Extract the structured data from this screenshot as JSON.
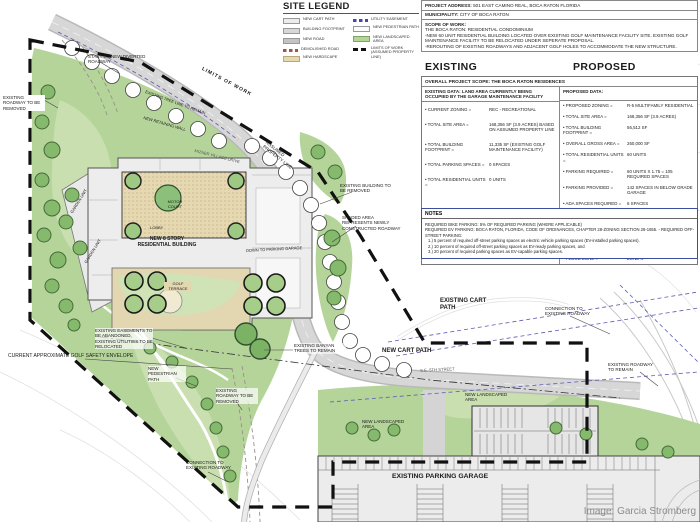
{
  "legend": {
    "title": "SITE LEGEND",
    "col1": [
      {
        "label": "NEW CART PATH"
      },
      {
        "label": "BUILDING FOOTPRINT"
      },
      {
        "label": "NEW ROAD"
      },
      {
        "label": "DEMOLISHED ROAD"
      },
      {
        "label": "NEW HARDSCAPE"
      }
    ],
    "col2": [
      {
        "label": "UTILITY EASEMENT"
      },
      {
        "label": "NEW PEDESTRIAN PATH"
      },
      {
        "label": "NEW LANDSCAPED AREA"
      },
      {
        "label": "LIMITS OF WORK (ASSUMED PROPERTY LINE)"
      }
    ]
  },
  "project": {
    "address_label": "PROJECT ADDRESS:",
    "address": "501 EAST CAMINO REAL, BOCA RATON FLORIDA",
    "municipality_label": "MUNICIPALITY:",
    "municipality": "CITY OF BOCA RATON",
    "scope_label": "SCOPE OF WORK:",
    "scope_line1": "THE BOCA RATON: RESIDENTIAL CONDOMINIUM",
    "scope_line2": "-NEW 60 UNIT RESIDENTIAL BUILDING LOCATED OVER EXISTING GOLF MAINTENANCE FACILITY SITE. EXISTING GOLF MAINTENANCE FACILITY TO BE RELOCATED UNDER SEPERATE PROPOSAL.",
    "scope_line3": "-REROUTING OF EXISTING ROADWAYS AND ADJACENT GOLF HOLES TO ACCOMMODATE THE NEW STRUCTURE."
  },
  "comparison": {
    "existing_header": "EXISTING",
    "proposed_header": "PROPOSED",
    "overall_scope": "OVERALL PROJECT SCOPE: THE BOCA RATON RESIDENCES",
    "existing_data_header": "EXISTING DATA: LAND AREA CURRENTLY BEING OCCUPIED BY THE GARAGE MAINTENANCE FACILITY",
    "proposed_data_header": "PROPOSED DATA:",
    "existing_rows": [
      {
        "label": "• CURRENT ZONING =",
        "value": "REC - RECREATIONAL"
      },
      {
        "label": "• TOTAL SITE AREA =",
        "value": "168,356 SF (3.9 ACRES) BASED ON ASSUMED PROPERTY LINE"
      },
      {
        "label": "• TOTAL BUILDING FOOTPRINT =",
        "value": "11,335 SF (EXISTING GOLF MAINTENANCE FACILITY)"
      },
      {
        "label": "• TOTAL PARKING SPACES =",
        "value": "0 SPACES"
      },
      {
        "label": "• TOTAL RESIDENTIAL UNITS =",
        "value": "0 UNITS"
      }
    ],
    "proposed_rows": [
      {
        "label": "• PROPOSED ZONING =",
        "value": "R-5 MULTIFAMILY RESIDENTIAL"
      },
      {
        "label": "• TOTAL SITE AREA =",
        "value": "168,356 SF (3.9 ACRES)"
      },
      {
        "label": "• TOTAL BUILDING FOOTPRINT =",
        "value": "56,512 SF"
      },
      {
        "label": "• OVERALL GROSS AREA =",
        "value": "260,000 SF"
      },
      {
        "label": "• TOTAL RESIDENTIAL UNITS =",
        "value": "60 UNITS"
      },
      {
        "label": "• PARKING REQUIRED =",
        "value": "60 UNITS X 1.75 = 105 REQUIRED SPACES"
      },
      {
        "label": "• PARKING PROVIDED =",
        "value": "142 SPACES IN BELOW GRADE GARAGE"
      },
      {
        "label": "• ADA SPACES REQUIRED =",
        "value": "6 SPACES"
      },
      {
        "label": "• ADA SPACES PROVIDED =",
        "value": "6 SPACES"
      },
      {
        "label": "• BUILDING HEIGHT =",
        "value": "100'-0\" TO TOP OF HIGHEST ROOF SLAB 120'-0\" TO HIGHEST POINT 8 STORIES OVER 1 BELOW GRADE PARKING LEVEL"
      },
      {
        "label": "• FLOOD ZONE =",
        "value": "ZONE X"
      }
    ]
  },
  "notes": {
    "header": "NOTES",
    "line1": "REQUIRED BIKE PARKING: 5% OF REQUIRED PARKING (WHERE APPLICABLE)",
    "line2": "REQUIRED EV PARKING: BOCA RATON, FLORIDA, CODE OF ORDINANCES, CHAPTER 28-ZONING SECTION 28-1655. - REQUIRED OFF-STREET PARKING:",
    "line3": "1.) 5 percent of required off-street parking spaces as electric vehicle parking spaces (EV-installed parking spaces).",
    "line4": "2.) 10 percent of required off-street parking spaces as EV-ready parking spaces, and",
    "line5": "3.) 20 percent of required parking spaces as EV-capable parking spaces."
  },
  "plan_labels": {
    "start_roadway": "START OF NEW DIVERTED ROADWAY",
    "roadway_removed_left": "EXISTING ROADWAY TO BE REMOVED",
    "limits_of_work": "LIMITS OF WORK",
    "tree_line": "EXISTING TREE LINE TO REMAIN",
    "retaining_wall": "NEW RETAINING WALL",
    "village_drive": "MIZNER VILLAGE DRIVE",
    "assumed_property_line": "ASSUMED PROPERTY LINE",
    "existing_building_removed": "EXISTING BUILDING TO BE REMOVED",
    "shaded_area": "SHADED AREA REPRESENTS NEWLY CONSTRUCTED ROADWAY",
    "down_to_parking": "DOWN TO PARKING GARAGE",
    "banyan_trees": "EXISTING BANYAN TREES TO REMAIN",
    "new_cart_path": "NEW CART PATH",
    "existing_cart_path": "EXISTING CART PATH",
    "connection_existing_roadway_right": "CONNECTION TO EXISTING ROADWAY",
    "existing_roadway_remain": "EXISTING ROADWAY TO REMAIN",
    "new_landscaped_area_1": "NEW LANDSCAPED AREA",
    "new_landscaped_area_2": "NEW LANDSCAPED AREA",
    "se_5th_street": "S.E. 5TH STREET",
    "existing_parking_garage": "EXISTING PARKING GARAGE",
    "easements": "EXISTING EASEMENTS TO BE ABANDONED, EXISTING UTILITIES TO BE RELOCATED",
    "golf_envelope": "CURRENT APPROXIMATE GOLF SAFETY ENVELOPE",
    "new_pedestrian_path": "NEW PEDESTRIAN PATH",
    "roadway_removed_bottom": "EXISTING ROADWAY TO BE REMOVED",
    "connection_existing_roadway_bottom": "CONNECTION TO EXISTING ROADWAY",
    "motor_court": "MOTOR COURT",
    "lobby": "LOBBY",
    "residential_building": "NEW 8 STORY RESIDENTIAL BUILDING",
    "golf_terrace": "GOLF TERRACE",
    "garden_unit_1": "GARDEN UNIT",
    "garden_unit_2": "GARDEN UNIT"
  },
  "credit": "Image: Garcia Stromberg",
  "colors": {
    "landscape_green": "#b5d49a",
    "hardscape_tan": "#e6d8b0",
    "road_gray": "#d2d2d2",
    "boundary_black": "#111111",
    "utility_blue": "#4848a8",
    "notes_border_blue": "#3a4fa0",
    "demolished_red": "#a05548"
  }
}
